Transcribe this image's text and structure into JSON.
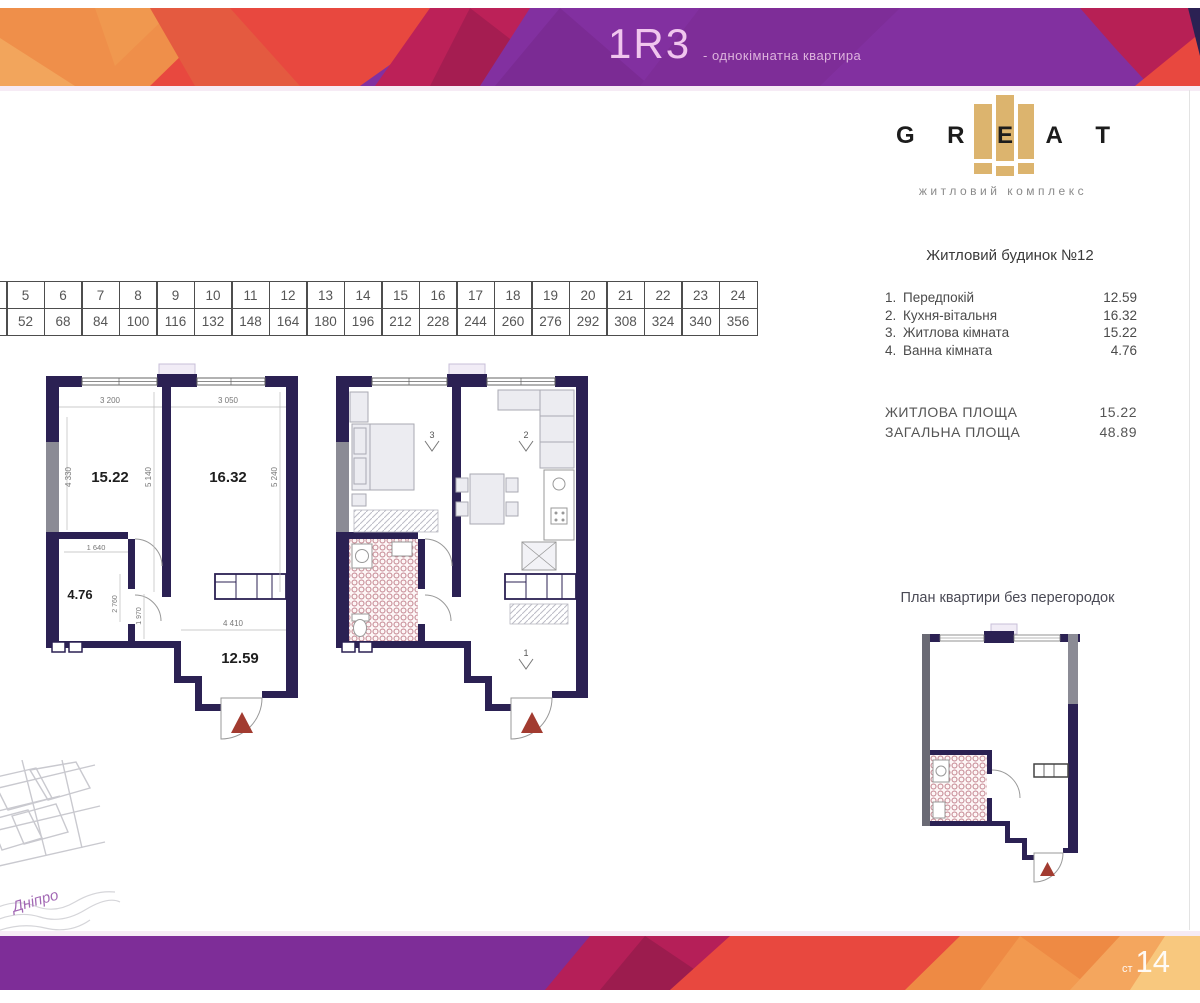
{
  "header": {
    "code": "1R3",
    "subtitle": "- однокімнатна квартира"
  },
  "logo": {
    "letters": [
      "G",
      "R",
      "E",
      "A",
      "T"
    ],
    "tagline": "житловий комплекс"
  },
  "right_panel": {
    "building_title": "Житловий будинок №12",
    "rooms": [
      {
        "num": "1.",
        "name": "Передпокій",
        "area": "12.59"
      },
      {
        "num": "2.",
        "name": "Кухня-вітальня",
        "area": "16.32"
      },
      {
        "num": "3.",
        "name": "Житлова кімната",
        "area": "15.22"
      },
      {
        "num": "4.",
        "name": "Ванна кімната",
        "area": "4.76"
      }
    ],
    "totals": [
      {
        "label": "ЖИТЛОВА ПЛОЩА",
        "value": "15.22"
      },
      {
        "label": "ЗАГАЛЬНА ПЛОЩА",
        "value": "48.89"
      }
    ],
    "no_partitions_title": "План квартири без перегородок"
  },
  "floors_table": {
    "columns": [
      {
        "floor": "5",
        "apt": "52"
      },
      {
        "floor": "6",
        "apt": "68"
      },
      {
        "floor": "7",
        "apt": "84"
      },
      {
        "floor": "8",
        "apt": "100"
      },
      {
        "floor": "9",
        "apt": "116"
      },
      {
        "floor": "10",
        "apt": "132"
      },
      {
        "floor": "11",
        "apt": "148"
      },
      {
        "floor": "12",
        "apt": "164"
      },
      {
        "floor": "13",
        "apt": "180"
      },
      {
        "floor": "14",
        "apt": "196"
      },
      {
        "floor": "15",
        "apt": "212"
      },
      {
        "floor": "16",
        "apt": "228"
      },
      {
        "floor": "17",
        "apt": "244"
      },
      {
        "floor": "18",
        "apt": "260"
      },
      {
        "floor": "19",
        "apt": "276"
      },
      {
        "floor": "20",
        "apt": "292"
      },
      {
        "floor": "21",
        "apt": "308"
      },
      {
        "floor": "22",
        "apt": "324"
      },
      {
        "floor": "23",
        "apt": "340"
      },
      {
        "floor": "24",
        "apt": "356"
      }
    ]
  },
  "plan_dimensioned": {
    "areas": {
      "living": "15.22",
      "kitchen": "16.32",
      "bath": "4.76",
      "hall": "12.59"
    },
    "dims": {
      "top_left": "3 200",
      "top_right": "3 050",
      "left": "4 330",
      "middle": "5 140",
      "right": "5 240",
      "bath_width": "1 640",
      "bath_height": "2 760",
      "corridor": "1 970",
      "hall_width": "4 410"
    }
  },
  "plan_furnished": {
    "markers": {
      "bedroom": "3",
      "kitchen": "2",
      "hall": "1"
    }
  },
  "map": {
    "river": "Дніпро"
  },
  "footer": {
    "page_prefix": "ст",
    "page_number": "14"
  },
  "colors": {
    "accent_purple": "#8230a0",
    "accent_crimson": "#b51f58",
    "accent_red": "#e8483f",
    "accent_orange": "#ee8a44",
    "accent_light_orange": "#f4a65e",
    "accent_pale_yellow": "#f8c87e",
    "wall_navy": "#2b2153",
    "facade_gray": "#8b8b95",
    "logo_gold": "#dcb46e",
    "entrance_arrow_red": "#a23b30",
    "tile_pink": "#c2838e"
  }
}
